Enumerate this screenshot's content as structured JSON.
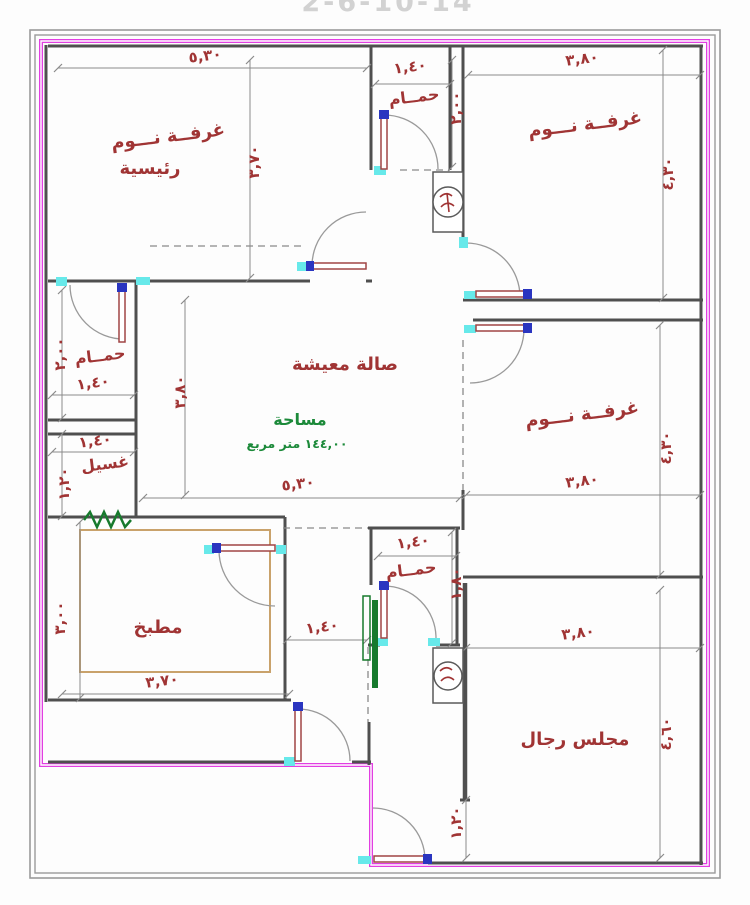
{
  "header": {
    "title": "2-6-10-14"
  },
  "palette": {
    "wall_gray": "#4f4f4f",
    "boundary_magenta": "#e23ee2",
    "opening_cyan": "#67e9ea",
    "label_red": "#a03434",
    "annotation_green": "#1c8a3a",
    "counter_tan": "#c9a26b",
    "dim_line_gray": "#8a8a8a",
    "door_handle_blue": "#2a35c0",
    "title_gray": "#d2d2d2"
  },
  "rooms": {
    "master_bedroom": {
      "name_line1": "غرفــة نـــوم",
      "name_line2": "رئيسية",
      "width": "٥,٣٠",
      "height": "٣,٧٠"
    },
    "bath_top": {
      "name": "حمــام",
      "width": "١,٤٠",
      "height": "٢,٠٠"
    },
    "bedroom_top_right": {
      "name": "غرفــة نـــوم",
      "width": "٣,٨٠",
      "height": "٤,٣٠"
    },
    "living_room": {
      "name": "صالة معيشة",
      "width": "٥,٣٠",
      "height": "٣,٨٠",
      "area_label": "مساحة",
      "area_value": "١٤٤,٠٠ متر مربع"
    },
    "bath_left": {
      "name": "حمــام",
      "width": "١,٤٠",
      "height": "٢,٠٠"
    },
    "laundry": {
      "name": "غسيل",
      "width": "١,٤٠",
      "height": "١,٢٠"
    },
    "kitchen": {
      "name": "مطبخ",
      "width": "٣,٧٠",
      "height": "٣,٠٠"
    },
    "hallway": {
      "width": "١,٤٠"
    },
    "bath_middle": {
      "name": "حمــام",
      "width": "١,٤٠",
      "height": "١,٨٠"
    },
    "bedroom_right": {
      "name": "غرفــة نـــوم",
      "width": "٣,٨٠",
      "height": "٤,٣٠"
    },
    "majlis": {
      "name": "مجلس رجال",
      "width": "٣,٨٠",
      "height": "٤,٦٠"
    },
    "entrance": {
      "width": "١,٢٠"
    }
  }
}
